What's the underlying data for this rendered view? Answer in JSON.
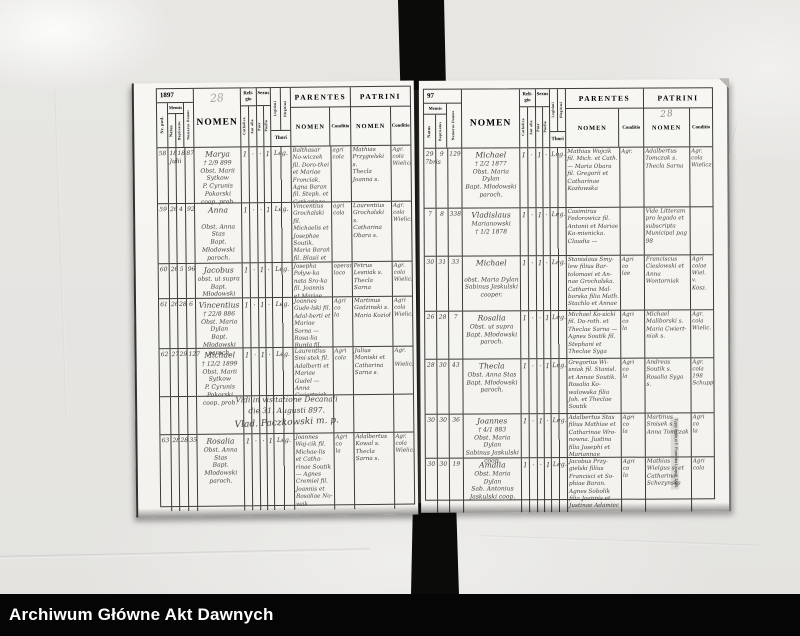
{
  "footer": {
    "label": "Archiwum Główne Akt Dawnych"
  },
  "colors": {
    "paper": "#e7e6e3",
    "page": "#f6f5f1",
    "ink": "#45413c",
    "line": "#3d3b38",
    "bar": "#050505"
  },
  "headers": {
    "year_left": "1897",
    "year_right": "97",
    "page_number": "28",
    "nr": "Nr. potł.",
    "mensis": "Mensis",
    "natus": "Natus",
    "baptisatus": "Baptisatus",
    "numerus_domus": "Numerus Domus",
    "nomen": "NOMEN",
    "religio": "Reli-\ngio",
    "catholica": "Catholica",
    "aut_alia": "Aut alia",
    "sexus": "Sexus",
    "puer": "Puer",
    "puella": "Puella",
    "legitimi": "Legitimi",
    "illegitimi": "Illegitimi",
    "thori": "Thori",
    "parentes": "PARENTES",
    "patrini": "PATRINI",
    "conditio": "Conditio"
  },
  "left_page": {
    "note_line1": "Vidi in visitatione Decanali",
    "note_line2": "die 31. Augusti 897.",
    "note_sig": "Vlad. Paczkowski m. p.",
    "rows": [
      {
        "nr": "58",
        "natus": "18\nJulii",
        "bapt": "18",
        "domus": "87",
        "nomen": "Marya\n† 2/9 899\nObst. Marii Sytkow\nP. Cyrunis Pokorski\ncoop. prob.",
        "cath": "1",
        "aut": "·",
        "puer": "·",
        "puella": "1",
        "thori": "Leg.",
        "par_nomen": "Balthasar No-wiczek fil. Doro-thei et Mariae Fronciak. Agna Baran fil. Steph. et Catharinae Grochalska. agr.",
        "par_cond": "agri cola",
        "pat_nomen": "Mathias Przygielski s.\nThecla Joanna s.",
        "pat_cond": "Agr.\ncola\nWielicka"
      },
      {
        "nr": "59",
        "natus": "26",
        "bapt": "4",
        "domus": "92",
        "nomen": "Anna\n\nObst. Anna Stas\nBapt. Młodowski\nparoch.",
        "cath": "1",
        "aut": "·",
        "puer": "·",
        "puella": "1",
        "thori": "Leg.",
        "par_nomen": "Vincentius Grochalski fil. Michaelis et Josephae Soutik. Maria Barań fil. Blasii et Agnetis Kowal",
        "par_cond": "agri cola",
        "pat_nomen": "Laurentius Grochalski s.\nCatharina Obara s.",
        "pat_cond": "Agr.\ncola\nWielicz."
      },
      {
        "nr": "60",
        "natus": "26",
        "bapt": "5",
        "domus": "96",
        "nomen": "Jacobus\nobst. ut supra\nBapt. Młodowski",
        "cath": "1",
        "aut": "·",
        "puer": "1",
        "puella": "·",
        "thori": "Leg.",
        "par_nomen": "Josepha Poływ-ka nata Sro-ka fil. Joannis et Mariae Soc.",
        "par_cond": "operaria loco",
        "pat_nomen": "Petrus Lesniak s.\nThecla Sarna",
        "pat_cond": "Agr.\ncola\nWielicz."
      },
      {
        "nr": "61",
        "natus": "26",
        "bapt": "28",
        "domus": "6",
        "nomen": "Vincentius\n† 22/8 886\nObst. Maria Dylan\nBapt. Młodowski\nparoch.",
        "cath": "1",
        "aut": "·",
        "puer": "1",
        "puella": "·",
        "thori": "Leg.",
        "par_nomen": "Joannes Gude-lski fil. Adal-berti et Mariae Sorna — Rosa-lia Burda fil. Martini et Agnetis Opielka",
        "par_cond": "Agri\nco\nla",
        "pat_nomen": "Martinus Gadzinski s.\nMaria Kozioł",
        "pat_cond": "Agri\ncola\nWielicz."
      },
      {
        "nr": "62",
        "natus": "27",
        "bapt": "29",
        "domus": "127",
        "nomen": "Michael\n† 12/2 1899\nObst. Marii Sytkow\nP. Cyrunis Pokorski\ncoop. prob.",
        "cath": "1",
        "aut": "·",
        "puer": "1",
        "puella": "·",
        "thori": "Leg.",
        "par_nomen": "Laurentius Smi-stek fil. Adalberti et Mariae Gudel — Anna Cwiertniak fil. Bartholomaei et Catharinae Smoronka",
        "par_cond": "Agri\ncola",
        "pat_nomen": "Julius Moniski et Catharina Sarna s.",
        "pat_cond": "Agr.\n\nWielicz."
      },
      {
        "nr": "63",
        "natus": "28",
        "bapt": "28",
        "domus": "35",
        "nomen": "Rosalia\nObst. Anna Stas\nBapt. Młodowski\nparoch.",
        "cath": "1",
        "aut": "·",
        "puer": "·",
        "puella": "1",
        "thori": "Leg.",
        "par_nomen": "Joannes Woj-cik fil. Michae-lis et Catha-rinae Soutik — Agnes Cremiel fil. Joannis et Rosaliae No-wak",
        "par_cond": "Agri\nco\nla",
        "pat_nomen": "Adalbertus Kowal s.\nThecla Sarna s.",
        "pat_cond": "Agr.\ncola\nWielicz."
      }
    ]
  },
  "right_page": {
    "imprint": "Typis Instituti F. Poremba Leopoli 1885.",
    "rows": [
      {
        "natus": "29\n7bris",
        "bapt": "9",
        "domus": "129",
        "nomen": "Michael\n† 2/2 1877\nObst. Maria Dylan\nBapt. Młodowski\nparoch.",
        "cath": "1",
        "aut": "·",
        "puer": "1",
        "puella": "·",
        "thori": "Leg.",
        "par_nomen": "Mathias Wojcik fil. Mich. et Cath. — Maria Obara fil. Gregorii et Catharinae Kozłowska",
        "par_cond": "Agr.",
        "pat_nomen": "Adalbertus Tomczak s.\nThecla Sarna",
        "pat_cond": "Agr.\ncola\nWielicz."
      },
      {
        "natus": "7",
        "bapt": "8",
        "domus": "338",
        "nomen": "Vladislaus\nMarianowski\n† 1/2 1878",
        "cath": "1",
        "aut": "·",
        "puer": "1",
        "puella": "·",
        "thori": "Leg.",
        "par_nomen": "Casimirus Fedorowicz fil. Antonii et Mariae Ka-mienicka. Claudia —",
        "par_cond": "",
        "pat_nomen": "Vide Litteram pro legado et subscripta Municipal pag 98",
        "pat_cond": ""
      },
      {
        "natus": "30",
        "bapt": "31",
        "domus": "33",
        "nomen": "Michael\n\nobst. Maria Dylan\nSabinus Jaskulski\ncooper.",
        "cath": "1",
        "aut": "·",
        "puer": "1",
        "puella": "·",
        "thori": "Leg.",
        "par_nomen": "Stanislaus Smy-lew filius Bar-tolomaei et An-nae Grochalska. Catharina Mal-borska filia Math. Stachlo et Annae Łazanowska",
        "par_cond": "Agri\nco\nlae",
        "pat_nomen": "Franciscus Cieslowski et\nAnna\nWontorniak",
        "pat_cond": "Agri\ncolae\nWiel.\nv. Kosz."
      },
      {
        "natus": "26",
        "bapt": "28",
        "domus": "7",
        "nomen": "Rosalia\nObst. ut supra\nBapt. Młodowski\nparoch.",
        "cath": "1",
        "aut": "·",
        "puer": "·",
        "puella": "1",
        "thori": "Leg.",
        "par_nomen": "Michael Ko-sicki fil. Do-roth. et Theclae Sarna — Agnes Soutik fil. Stephani et Theclae Syga",
        "par_cond": "Agri\nco\nla",
        "pat_nomen": "Michael Maliborski s.\nMaria Cwiert-niak s.",
        "pat_cond": "Agr.\ncola\nWielic."
      },
      {
        "natus": "28",
        "bapt": "30",
        "domus": "43",
        "nomen": "Thecla\nObst. Anna Stas\nBapt. Młodowski\nparoch.",
        "cath": "1",
        "aut": "·",
        "puer": "·",
        "puella": "1",
        "thori": "Leg.",
        "par_nomen": "Gregorius Wi-sniak fil. Stanisl. et Annae Soutik. Rosalia Ko-walowska filia Joh. et Theclae Soutik",
        "par_cond": "Agri\nco\nla",
        "pat_nomen": "Andreas Soutik s.\nRosalia Syga s.",
        "pat_cond": "Agr.\ncola\n198\nSchupp."
      },
      {
        "natus": "30",
        "bapt": "30",
        "domus": "36",
        "nomen": "Joannes\n† 4/1 883\nObst. Maria Dylan\nSabinus Jaskulski\ncoop.",
        "cath": "1",
        "aut": "·",
        "puer": "1",
        "puella": "·",
        "thori": "Leg.",
        "par_nomen": "Adalbertus Stas filius Mathiae et Catharinae Wro-nowna. Justina filia Josephi et Mariannae Adamiec",
        "par_cond": "Agri\nco\nla",
        "pat_nomen": "Martinus Smisek s.\nAnna Tomczak",
        "pat_cond": "Agri\nco\nla"
      },
      {
        "natus": "30",
        "bapt": "30",
        "domus": "19",
        "nomen": "Amalia\nObst. Maria Dylan\nSab. Antonius Jaskulski coop.",
        "cath": "1",
        "aut": "·",
        "puer": "·",
        "puella": "1",
        "thori": "Leg.",
        "par_nomen": "Jacobus Przy-gielski filius Francisci et So-phiae Baran. Agnes Sobolik filia Joannis et Justinae Adamiec",
        "par_cond": "Agri\nco\nla",
        "pat_nomen": "Mathias Wielgus s. et Catharina Schezynska",
        "pat_cond": "Agri\ncola"
      }
    ]
  }
}
